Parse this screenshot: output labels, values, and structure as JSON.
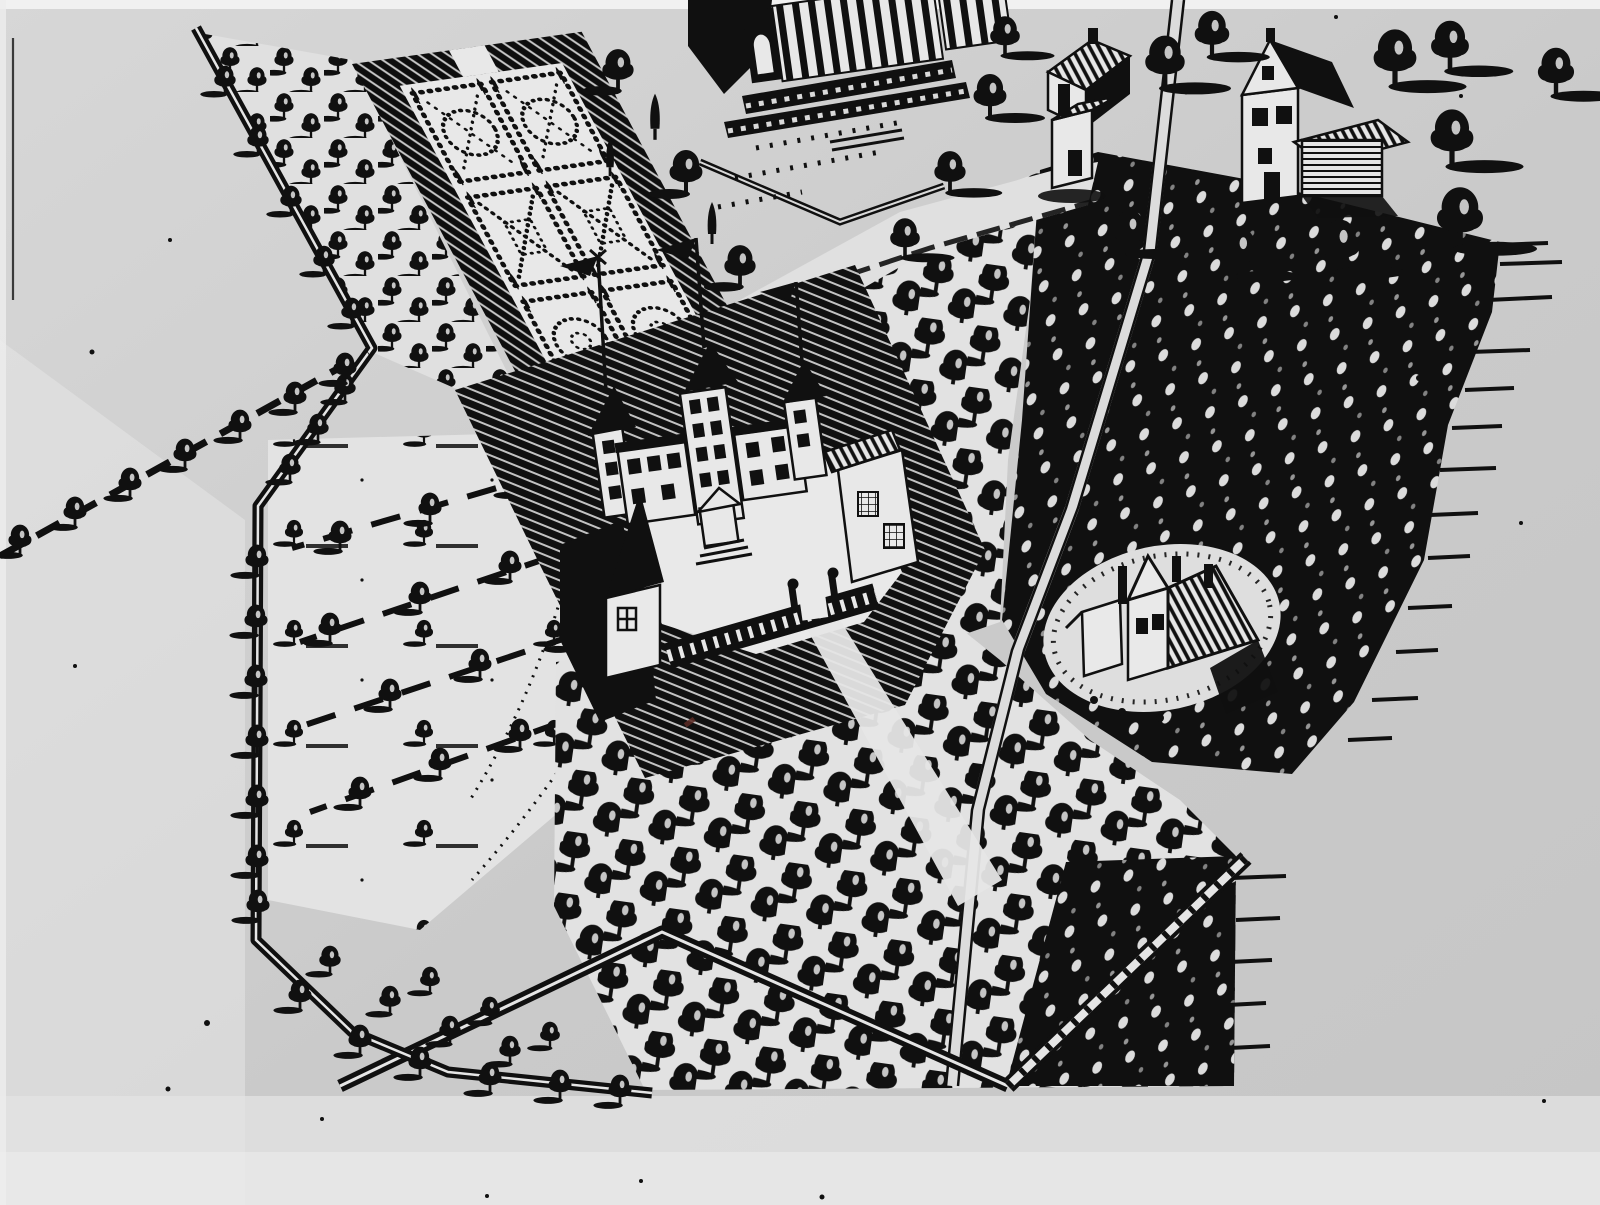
{
  "scene": {
    "kind": "engraved-birdseye-estate-map",
    "medium": "black ink engraving photographed on grey paper",
    "orientation": "oblique axonometric view, plots sheared down-right",
    "palette": {
      "paper": "#cbcbcb",
      "paper_light": "#e8e8e8",
      "paper_bright": "#f1f1f1",
      "ink": "#101010",
      "fleck": "#dcdcdc",
      "stray_red_speck": "#5a2a24"
    },
    "regions": [
      {
        "id": "parterre-garden",
        "label": "walled formal garden",
        "beds": 6,
        "bed_layout": "2 columns x 3 rows",
        "wall": "hatched masonry band"
      },
      {
        "id": "manor-complex",
        "label": "manor with towers and courtyard",
        "flagpoles": 3,
        "towers": 3,
        "gatehouse": 1,
        "garden-pavilion": 1,
        "fence": "paling fence with ball-top posts"
      },
      {
        "id": "grand-building",
        "label": "large columned building cut by top edge",
        "features": [
          "colonnade",
          "terraced steps",
          "terrace wall",
          "tiny figures"
        ]
      },
      {
        "id": "hamlet-north-east",
        "label": "cluster of village houses",
        "houses": 4,
        "barn_with_log_walls": 1
      },
      {
        "id": "farmstead-clearing",
        "label": "farmhouse in clearing ringed by shrubs",
        "buildings": 3,
        "chimneys": 3
      },
      {
        "id": "dense-woods",
        "label": "dense dark woodland, ragged east edge with streaks"
      },
      {
        "id": "orchards",
        "label": "row-planted orchards with left-cast shadows"
      },
      {
        "id": "open-field",
        "label": "sparse field with tree avenues and dotted footpaths"
      },
      {
        "id": "estate-boundary",
        "label": "double-line boundary wall lined with trees"
      },
      {
        "id": "roads",
        "label": "thin double-line roads",
        "segments": [
          "long road top to bottom",
          "zigzag road bottom",
          "fenced ladder road bottom-right",
          "white road past garden"
        ]
      }
    ]
  }
}
